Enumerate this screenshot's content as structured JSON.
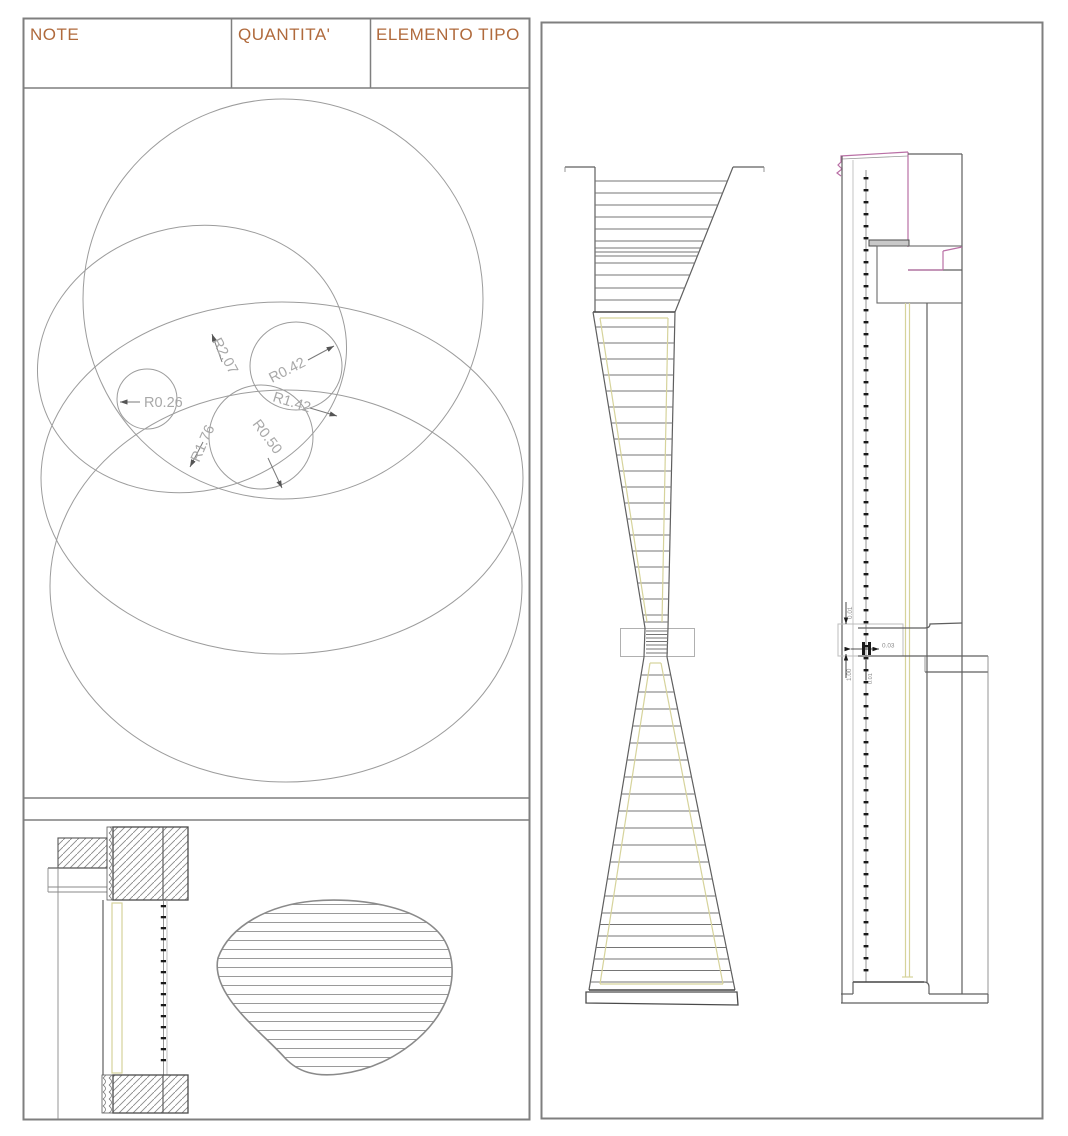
{
  "panels": {
    "left": {
      "header": {
        "columns": [
          {
            "label": "NOTE"
          },
          {
            "label": "QUANTITA'"
          },
          {
            "label": "ELEMENTO TIPO"
          }
        ]
      },
      "radius_labels": [
        {
          "text": "R0.26"
        },
        {
          "text": "R2.07"
        },
        {
          "text": "R0.42"
        },
        {
          "text": "R1.42"
        },
        {
          "text": "R1.76"
        },
        {
          "text": "R0.50"
        }
      ]
    },
    "right": {
      "dimensions": [
        {
          "text": "0.01"
        },
        {
          "text": "0.03"
        },
        {
          "text": "1.00"
        },
        {
          "text": "0.01"
        }
      ]
    }
  },
  "colors": {
    "accent_orange": "#b06a3c",
    "line_gray": "#8a8a8a",
    "magenta": "#b96fa5",
    "olive_glass": "#d6d39b",
    "tick_black": "#1a1a1a"
  }
}
